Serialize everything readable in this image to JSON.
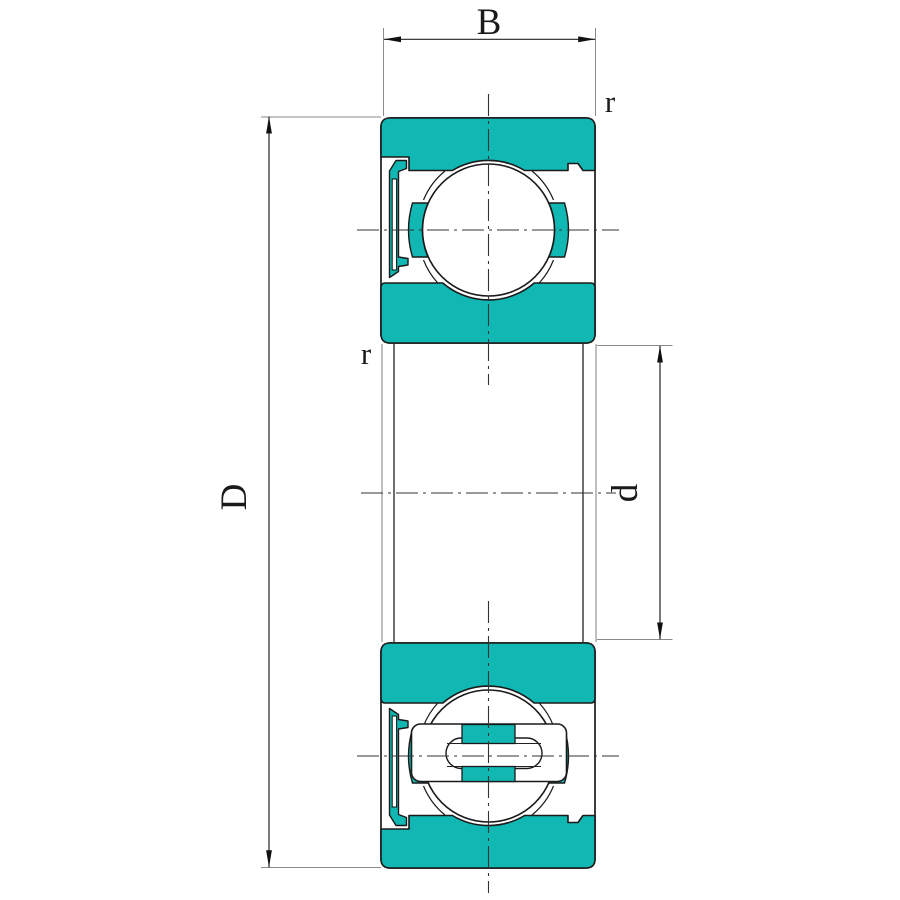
{
  "figure": {
    "type": "technical-drawing",
    "subject": "deep groove ball bearing cross-section with shield and riveted cage",
    "background": "#ffffff"
  },
  "labels": {
    "width": "B",
    "outer_diameter": "D",
    "bore_diameter": "d",
    "radius_outer_corner": "r",
    "radius_inner_corner": "r"
  },
  "colors": {
    "ring_fill": "#11b7b2",
    "outline": "#1a1a1a",
    "dim_line": "#222222",
    "ext_line": "#8a8a8a",
    "centerline": "#333333"
  }
}
